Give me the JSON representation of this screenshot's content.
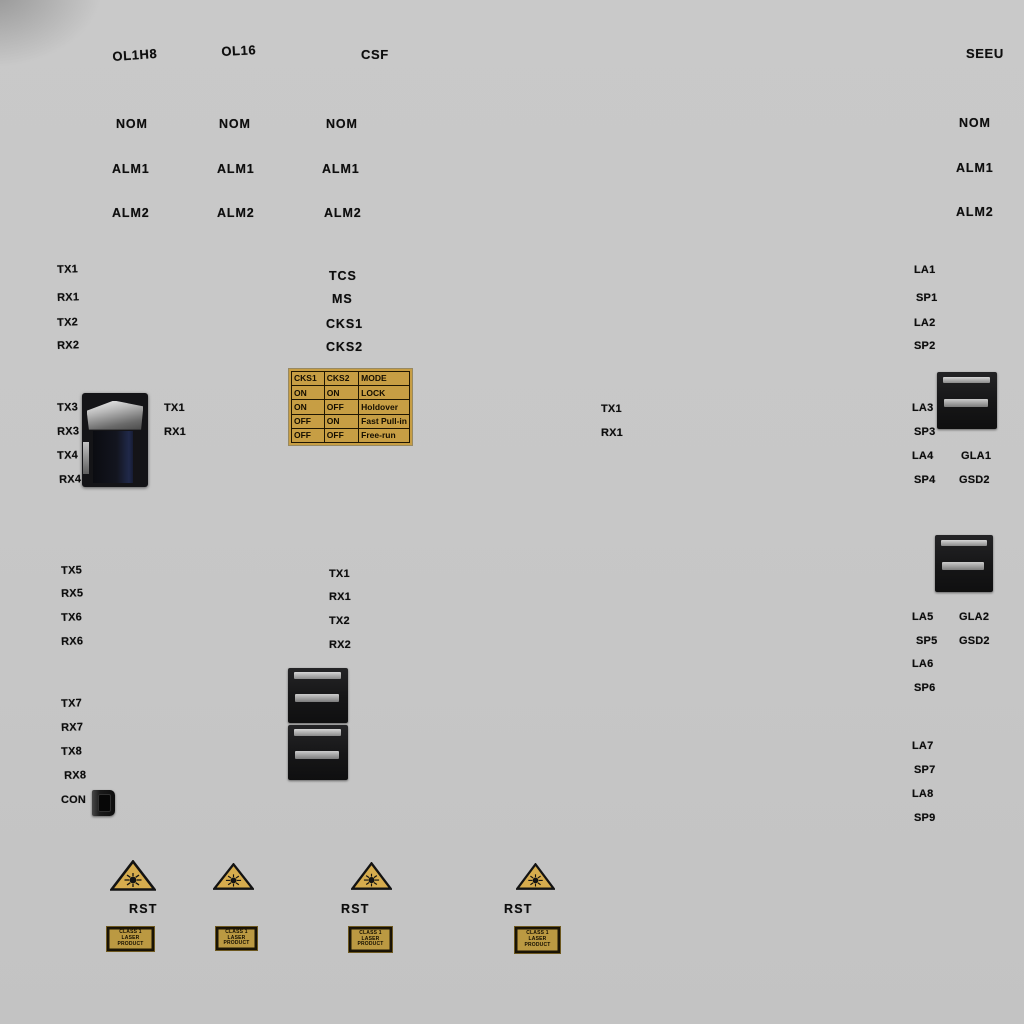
{
  "meta": {
    "panel_bg": "#c7c7c7",
    "ink_color": "#0e0e0e",
    "gold_color": "#c79e44",
    "triangle_fill": "#d6ac4e"
  },
  "labels": [
    {
      "k": "board-title",
      "t": "OL1H8",
      "x": 112,
      "y": 50,
      "c": "hdr",
      "r": -4
    },
    {
      "k": "board-title",
      "t": "OL16",
      "x": 221,
      "y": 45,
      "c": "hdr",
      "r": -3
    },
    {
      "k": "board-title",
      "t": "CSF",
      "x": 361,
      "y": 48,
      "c": "hdr",
      "r": 0
    },
    {
      "k": "board-title",
      "t": "SEEU",
      "x": 966,
      "y": 47,
      "c": "hdr",
      "r": 0
    },
    {
      "k": "led-label",
      "t": "NOM",
      "x": 116,
      "y": 118,
      "c": "led",
      "r": 0
    },
    {
      "k": "led-label",
      "t": "NOM",
      "x": 219,
      "y": 118,
      "c": "led",
      "r": 0
    },
    {
      "k": "led-label",
      "t": "NOM",
      "x": 326,
      "y": 118,
      "c": "led",
      "r": 0
    },
    {
      "k": "led-label",
      "t": "NOM",
      "x": 959,
      "y": 117,
      "c": "led",
      "r": 0
    },
    {
      "k": "led-label",
      "t": "ALM1",
      "x": 112,
      "y": 163,
      "c": "led",
      "r": 0
    },
    {
      "k": "led-label",
      "t": "ALM1",
      "x": 217,
      "y": 163,
      "c": "led",
      "r": 0
    },
    {
      "k": "led-label",
      "t": "ALM1",
      "x": 322,
      "y": 163,
      "c": "led",
      "r": 0
    },
    {
      "k": "led-label",
      "t": "ALM1",
      "x": 956,
      "y": 162,
      "c": "led",
      "r": 0
    },
    {
      "k": "led-label",
      "t": "ALM2",
      "x": 112,
      "y": 207,
      "c": "led",
      "r": 0
    },
    {
      "k": "led-label",
      "t": "ALM2",
      "x": 217,
      "y": 207,
      "c": "led",
      "r": 0
    },
    {
      "k": "led-label",
      "t": "ALM2",
      "x": 324,
      "y": 207,
      "c": "led",
      "r": 0
    },
    {
      "k": "led-label",
      "t": "ALM2",
      "x": 956,
      "y": 206,
      "c": "led",
      "r": 0
    },
    {
      "k": "port-label",
      "t": "TX1",
      "x": 57,
      "y": 265,
      "c": "port",
      "r": -2
    },
    {
      "k": "port-label",
      "t": "RX1",
      "x": 57,
      "y": 293,
      "c": "port",
      "r": -2
    },
    {
      "k": "port-label",
      "t": "TX2",
      "x": 57,
      "y": 318,
      "c": "port",
      "r": -2
    },
    {
      "k": "port-label",
      "t": "RX2",
      "x": 57,
      "y": 341,
      "c": "port",
      "r": -2
    },
    {
      "k": "signal-label",
      "t": "TCS",
      "x": 329,
      "y": 270,
      "c": "led",
      "r": 0
    },
    {
      "k": "signal-label",
      "t": "MS",
      "x": 332,
      "y": 293,
      "c": "led",
      "r": 0
    },
    {
      "k": "signal-label",
      "t": "CKS1",
      "x": 326,
      "y": 318,
      "c": "led",
      "r": 0
    },
    {
      "k": "signal-label",
      "t": "CKS2",
      "x": 326,
      "y": 341,
      "c": "led",
      "r": 0
    },
    {
      "k": "port-label",
      "t": "LA1",
      "x": 914,
      "y": 265,
      "c": "port",
      "r": 0
    },
    {
      "k": "port-label",
      "t": "SP1",
      "x": 916,
      "y": 293,
      "c": "port",
      "r": 0
    },
    {
      "k": "port-label",
      "t": "LA2",
      "x": 914,
      "y": 318,
      "c": "port",
      "r": 0
    },
    {
      "k": "port-label",
      "t": "SP2",
      "x": 914,
      "y": 341,
      "c": "port",
      "r": 0
    },
    {
      "k": "port-label",
      "t": "TX3",
      "x": 57,
      "y": 403,
      "c": "port",
      "r": -2
    },
    {
      "k": "port-label",
      "t": "RX3",
      "x": 57,
      "y": 427,
      "c": "port",
      "r": -2
    },
    {
      "k": "port-label",
      "t": "TX4",
      "x": 57,
      "y": 451,
      "c": "port",
      "r": -2
    },
    {
      "k": "port-label",
      "t": "RX4",
      "x": 59,
      "y": 475,
      "c": "port",
      "r": -2
    },
    {
      "k": "port-label",
      "t": "TX1",
      "x": 164,
      "y": 403,
      "c": "port",
      "r": 0
    },
    {
      "k": "port-label",
      "t": "RX1",
      "x": 164,
      "y": 427,
      "c": "port",
      "r": 0
    },
    {
      "k": "port-label",
      "t": "TX1",
      "x": 601,
      "y": 404,
      "c": "port",
      "r": 0
    },
    {
      "k": "port-label",
      "t": "RX1",
      "x": 601,
      "y": 428,
      "c": "port",
      "r": 0
    },
    {
      "k": "port-label",
      "t": "LA3",
      "x": 912,
      "y": 403,
      "c": "port",
      "r": 0
    },
    {
      "k": "port-label",
      "t": "SP3",
      "x": 914,
      "y": 427,
      "c": "port",
      "r": 0
    },
    {
      "k": "port-label",
      "t": "LA4",
      "x": 912,
      "y": 451,
      "c": "port",
      "r": 0
    },
    {
      "k": "port-label",
      "t": "GLA1",
      "x": 961,
      "y": 451,
      "c": "port",
      "r": 0
    },
    {
      "k": "port-label",
      "t": "SP4",
      "x": 914,
      "y": 475,
      "c": "port",
      "r": 0
    },
    {
      "k": "port-label",
      "t": "GSD2",
      "x": 959,
      "y": 475,
      "c": "port",
      "r": 0
    },
    {
      "k": "port-label",
      "t": "TX5",
      "x": 61,
      "y": 566,
      "c": "port",
      "r": -2
    },
    {
      "k": "port-label",
      "t": "RX5",
      "x": 61,
      "y": 589,
      "c": "port",
      "r": -2
    },
    {
      "k": "port-label",
      "t": "TX6",
      "x": 61,
      "y": 613,
      "c": "port",
      "r": -2
    },
    {
      "k": "port-label",
      "t": "RX6",
      "x": 61,
      "y": 637,
      "c": "port",
      "r": -2
    },
    {
      "k": "port-label",
      "t": "TX1",
      "x": 329,
      "y": 569,
      "c": "port",
      "r": 0
    },
    {
      "k": "port-label",
      "t": "RX1",
      "x": 329,
      "y": 592,
      "c": "port",
      "r": 0
    },
    {
      "k": "port-label",
      "t": "TX2",
      "x": 329,
      "y": 616,
      "c": "port",
      "r": 0
    },
    {
      "k": "port-label",
      "t": "RX2",
      "x": 329,
      "y": 640,
      "c": "port",
      "r": 0
    },
    {
      "k": "port-label",
      "t": "LA5",
      "x": 912,
      "y": 612,
      "c": "port",
      "r": 0
    },
    {
      "k": "port-label",
      "t": "GLA2",
      "x": 959,
      "y": 612,
      "c": "port",
      "r": 0
    },
    {
      "k": "port-label",
      "t": "SP5",
      "x": 916,
      "y": 636,
      "c": "port",
      "r": 0
    },
    {
      "k": "port-label",
      "t": "GSD2",
      "x": 959,
      "y": 636,
      "c": "port",
      "r": 0
    },
    {
      "k": "port-label",
      "t": "LA6",
      "x": 912,
      "y": 659,
      "c": "port",
      "r": 0
    },
    {
      "k": "port-label",
      "t": "SP6",
      "x": 914,
      "y": 683,
      "c": "port",
      "r": 0
    },
    {
      "k": "port-label",
      "t": "TX7",
      "x": 61,
      "y": 699,
      "c": "port",
      "r": -2
    },
    {
      "k": "port-label",
      "t": "RX7",
      "x": 61,
      "y": 723,
      "c": "port",
      "r": -2
    },
    {
      "k": "port-label",
      "t": "TX8",
      "x": 61,
      "y": 747,
      "c": "port",
      "r": -2
    },
    {
      "k": "port-label",
      "t": "RX8",
      "x": 64,
      "y": 771,
      "c": "port",
      "r": -2
    },
    {
      "k": "port-label",
      "t": "CON",
      "x": 61,
      "y": 795,
      "c": "port",
      "r": 0
    },
    {
      "k": "port-label",
      "t": "LA7",
      "x": 912,
      "y": 741,
      "c": "port",
      "r": 0
    },
    {
      "k": "port-label",
      "t": "SP7",
      "x": 914,
      "y": 765,
      "c": "port",
      "r": 0
    },
    {
      "k": "port-label",
      "t": "LA8",
      "x": 912,
      "y": 789,
      "c": "port",
      "r": 0
    },
    {
      "k": "port-label",
      "t": "SP9",
      "x": 914,
      "y": 813,
      "c": "port",
      "r": 0
    },
    {
      "k": "rst-label",
      "t": "RST",
      "x": 129,
      "y": 903,
      "c": "rst",
      "r": 0
    },
    {
      "k": "rst-label",
      "t": "RST",
      "x": 341,
      "y": 903,
      "c": "rst",
      "r": 0
    },
    {
      "k": "rst-label",
      "t": "RST",
      "x": 504,
      "y": 903,
      "c": "rst",
      "r": 0
    }
  ],
  "mode_table": {
    "x": 289,
    "y": 369,
    "w": 119,
    "h": 72,
    "col_widths": [
      34,
      36,
      49
    ],
    "headers": [
      "CKS1",
      "CKS2",
      "MODE"
    ],
    "rows": [
      [
        "ON",
        "ON",
        "LOCK"
      ],
      [
        "ON",
        "OFF",
        "Holdover"
      ],
      [
        "OFF",
        "ON",
        "Fast Pull-in"
      ],
      [
        "OFF",
        "OFF",
        "Free-run"
      ]
    ]
  },
  "connectors": [
    {
      "name": "fiber-connector-left",
      "type": "fiber-metal",
      "x": 82,
      "y": 393,
      "w": 66,
      "h": 94
    },
    {
      "name": "fiber-connector-right-top",
      "type": "sc",
      "x": 937,
      "y": 372,
      "w": 60,
      "h": 57
    },
    {
      "name": "fiber-connector-right-mid",
      "type": "sc",
      "x": 935,
      "y": 535,
      "w": 58,
      "h": 57
    },
    {
      "name": "fiber-connector-center-top",
      "type": "sc",
      "x": 288,
      "y": 668,
      "w": 60,
      "h": 55
    },
    {
      "name": "fiber-connector-center-bottom",
      "type": "sc",
      "x": 288,
      "y": 725,
      "w": 60,
      "h": 55
    },
    {
      "name": "con-port",
      "type": "mini",
      "x": 92,
      "y": 790,
      "w": 23,
      "h": 26
    }
  ],
  "laser_triangles": [
    {
      "x": 110,
      "y": 860,
      "w": 46,
      "h": 31
    },
    {
      "x": 213,
      "y": 863,
      "w": 41,
      "h": 27
    },
    {
      "x": 351,
      "y": 862,
      "w": 41,
      "h": 28
    },
    {
      "x": 516,
      "y": 863,
      "w": 39,
      "h": 27
    }
  ],
  "stickers": [
    {
      "x": 107,
      "y": 927,
      "w": 45,
      "h": 22
    },
    {
      "x": 216,
      "y": 927,
      "w": 39,
      "h": 21
    },
    {
      "x": 349,
      "y": 927,
      "w": 41,
      "h": 23
    },
    {
      "x": 515,
      "y": 927,
      "w": 43,
      "h": 24
    }
  ],
  "sticker_lines": [
    "CLASS 1",
    "LASER",
    "PRODUCT"
  ]
}
